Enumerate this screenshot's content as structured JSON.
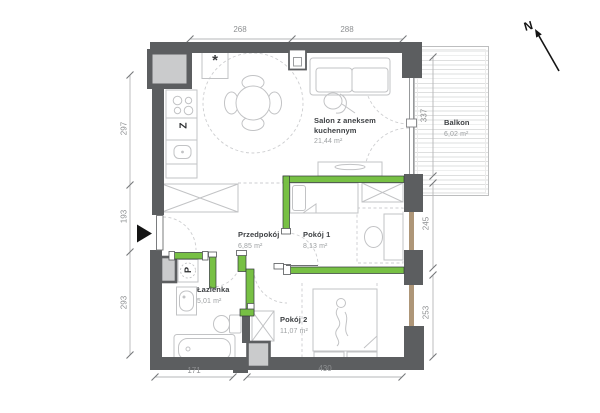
{
  "compass": {
    "label": "N"
  },
  "rooms": {
    "salon": {
      "name": "Salon z aneksem kuchennym",
      "area": "21,44 m²"
    },
    "balkon": {
      "name": "Balkon",
      "area": "6,02 m²"
    },
    "przedpokoj": {
      "name": "Przedpokój",
      "area": "6,85 m²"
    },
    "pokoj1": {
      "name": "Pokój 1",
      "area": "8,13 m²"
    },
    "lazienka": {
      "name": "Łazienka",
      "area": "5,01 m²"
    },
    "pokoj2": {
      "name": "Pokój 2",
      "area": "11,07 m²"
    }
  },
  "annotations": {
    "kitchen_asterisk": "*",
    "dishwasher": "Z",
    "washing_machine": "P"
  },
  "dimensions": {
    "top": [
      "268",
      "288"
    ],
    "left": [
      "297",
      "193",
      "293"
    ],
    "right": [
      "337",
      "245",
      "253"
    ],
    "bottom": [
      "171",
      "430"
    ]
  },
  "colors": {
    "wall": "#5c5e60",
    "highlight_green": "#77c044",
    "shaft_fill": "#cacbcc",
    "window_frame": "#ae9678",
    "furniture_line": "#c2c3c5",
    "dimension_text": "#8e9092",
    "room_label": "#3e4144",
    "area_text": "#9da0a2"
  }
}
